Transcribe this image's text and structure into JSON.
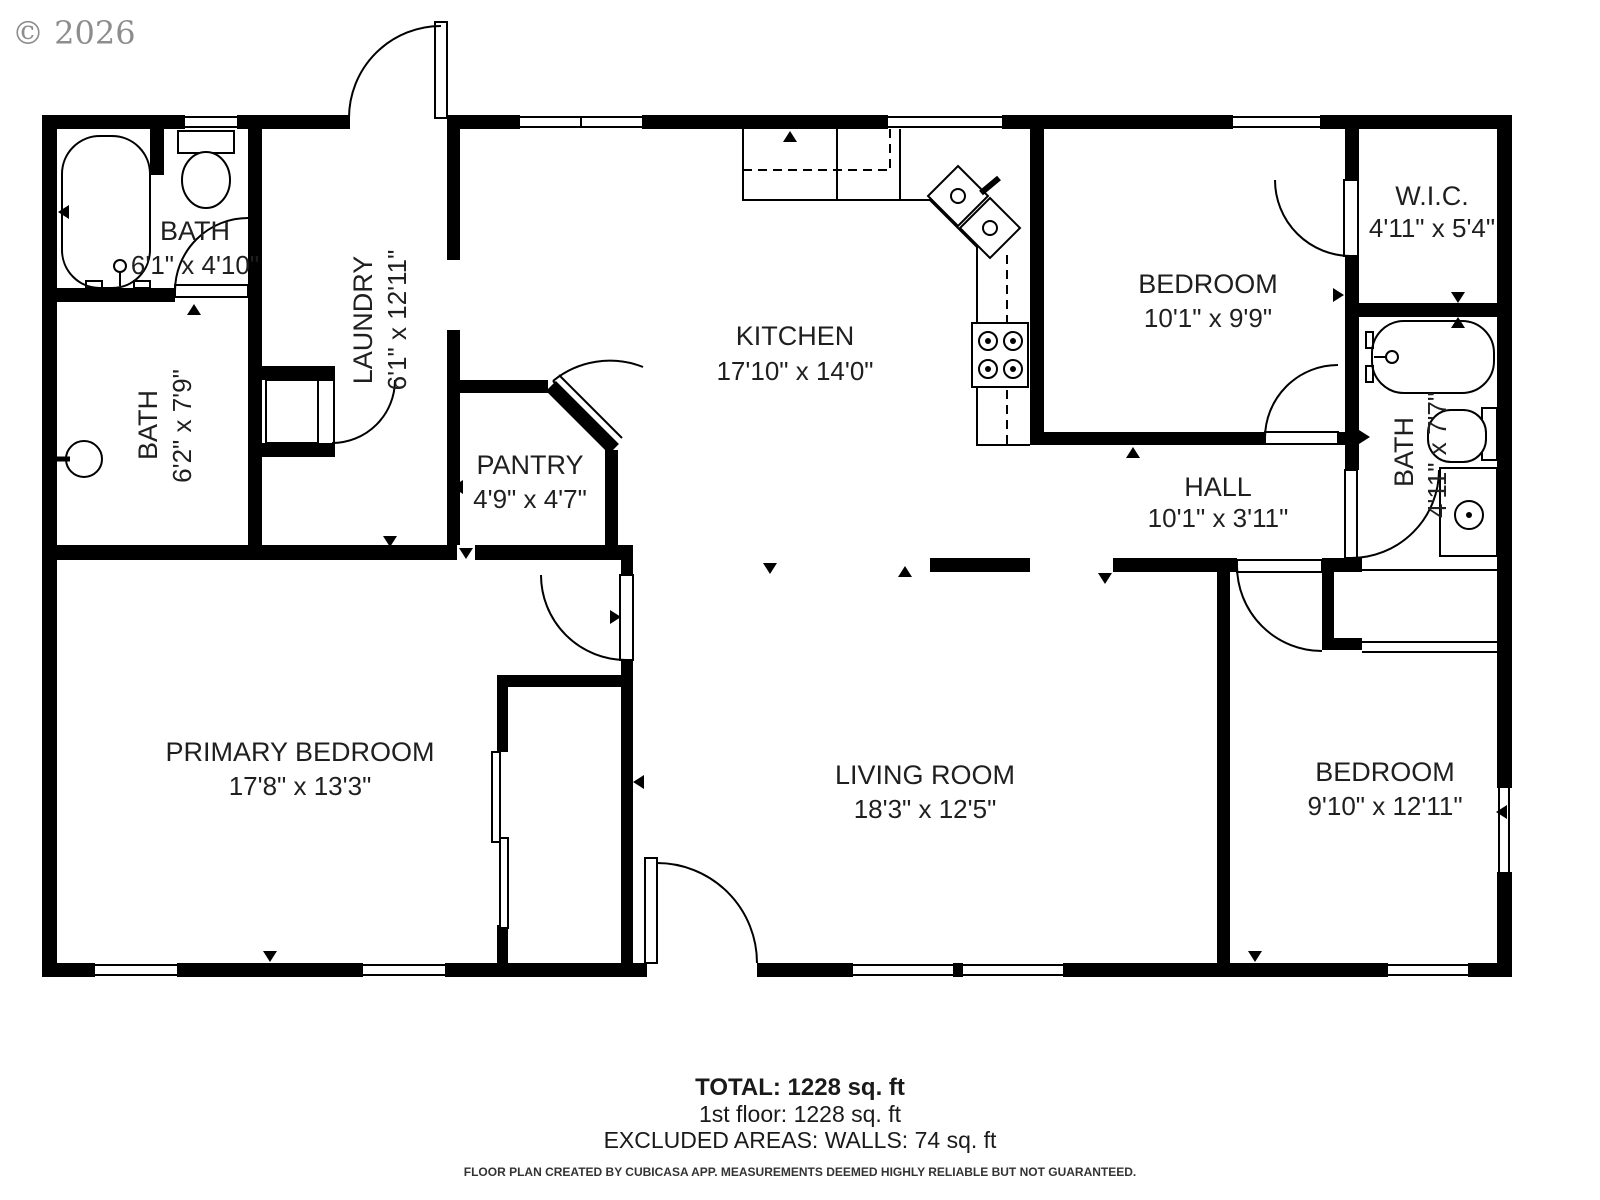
{
  "copyright": "© 2026",
  "rooms": {
    "bath_top_left": {
      "name": "BATH",
      "dims": "6'1\" x 4'10\""
    },
    "laundry": {
      "name": "LAUNDRY",
      "dims": "6'1\" x 12'11\""
    },
    "kitchen": {
      "name": "KITCHEN",
      "dims": "17'10\" x 14'0\""
    },
    "bedroom_top": {
      "name": "BEDROOM",
      "dims": "10'1\" x 9'9\""
    },
    "wic": {
      "name": "W.I.C.",
      "dims": "4'11\" x 5'4\""
    },
    "bath_left": {
      "name": "BATH",
      "dims": "6'2\" x 7'9\""
    },
    "pantry": {
      "name": "PANTRY",
      "dims": "4'9\" x 4'7\""
    },
    "hall": {
      "name": "HALL",
      "dims": "10'1\" x 3'11\""
    },
    "bath_right": {
      "name": "BATH",
      "dims": "4'11\" x 7'7\""
    },
    "primary_bedroom": {
      "name": "PRIMARY BEDROOM",
      "dims": "17'8\" x 13'3\""
    },
    "living_room": {
      "name": "LIVING ROOM",
      "dims": "18'3\" x 12'5\""
    },
    "bedroom_right": {
      "name": "BEDROOM",
      "dims": "9'10\" x 12'11\""
    }
  },
  "summary": {
    "total": "TOTAL: 1228 sq. ft",
    "floor": "1st floor: 1228 sq. ft",
    "excluded": "EXCLUDED AREAS: WALLS: 74 sq. ft"
  },
  "disclaimer": "FLOOR PLAN CREATED BY CUBICASA APP. MEASUREMENTS DEEMED HIGHLY RELIABLE BUT NOT GUARANTEED.",
  "colors": {
    "wall": "#000000",
    "text": "#1f1f1f",
    "copyright": "#8d8d8d"
  }
}
